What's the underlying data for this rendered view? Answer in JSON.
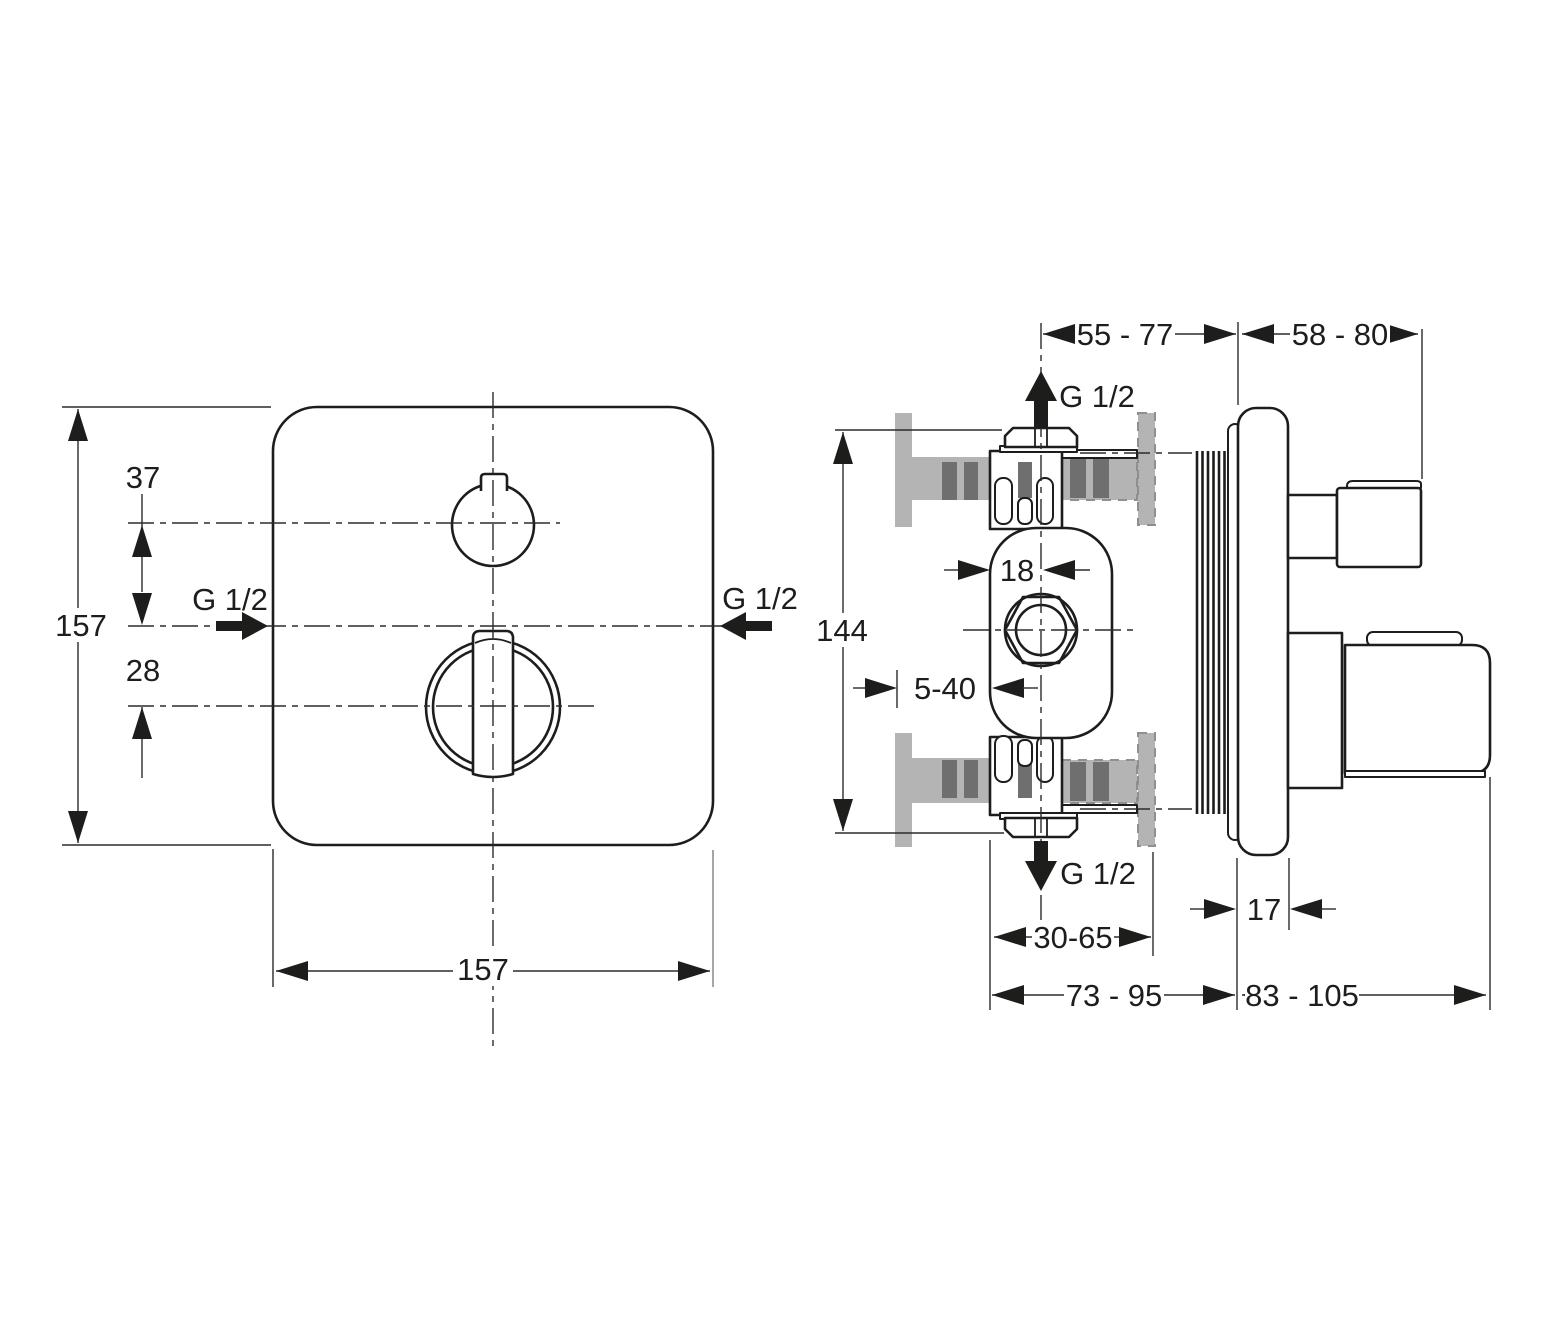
{
  "front_view": {
    "dims": {
      "height": "157",
      "width": "157",
      "top_offset": "37",
      "bottom_offset": "28"
    },
    "ports": {
      "left": "G 1/2",
      "right": "G 1/2"
    }
  },
  "side_view": {
    "dims": {
      "inner_span": "55 - 77",
      "outer_span": "58 - 80",
      "body_height": "144",
      "center_offset": "18",
      "plaster_depth": "5-40",
      "wall_thickness": "30-65",
      "plate_thickness": "17",
      "inner_depth": "73 - 95",
      "outer_depth": "83 - 105"
    },
    "ports": {
      "top": "G 1/2",
      "bottom": "G 1/2"
    }
  },
  "colors": {
    "line": "#1d1d1b",
    "dim_line": "#2b2b2b",
    "wall_gray": "#b4b4b4",
    "wall_dark_gray": "#6f6f6f",
    "background": "#ffffff"
  }
}
